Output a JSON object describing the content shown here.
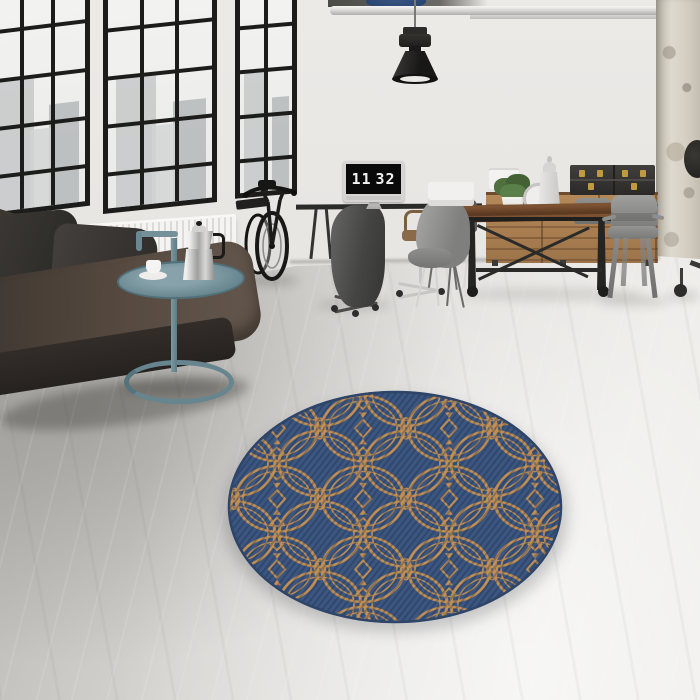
{
  "scene": {
    "description": "Industrial loft interior with black-framed windows, leather sofa, bicycle, work desk, wooden dining set and a round blue-and-tan patterned rug on a concrete floor"
  },
  "clock": {
    "hours": "11",
    "minutes": "32"
  },
  "colors": {
    "windowFrame": "#1c1c1a",
    "wallLight": "#e9e7e4",
    "floorDark": "#a7a6a3",
    "floorLight": "#edece9",
    "sofaLeather": "#49403a",
    "pillowDark": "#302d2a",
    "radiatorWhite": "#f5f4f2",
    "sideTableTeal": "#6f8d96",
    "mokaSilver": "#d9d9d9",
    "deskBlack": "#2b2b29",
    "monitorSilver": "#d6d5d3",
    "screenBlack": "#0a0a0a",
    "clockDigits": "#f2f2f2",
    "tableWood": "#6e4a2c",
    "ironBlack": "#242422",
    "sideboardWood": "#a87e52",
    "boxBlack": "#343330",
    "brass": "#c09a3e",
    "plantGreen": "#4f7040",
    "tolixGrey": "#8a8a88",
    "lampBlack": "#232321",
    "columnBeige": "#cfc6b4",
    "rugBlue": "#3b5680",
    "rugPattern": "#bf8f55",
    "rugEdge": "#2e4468"
  }
}
